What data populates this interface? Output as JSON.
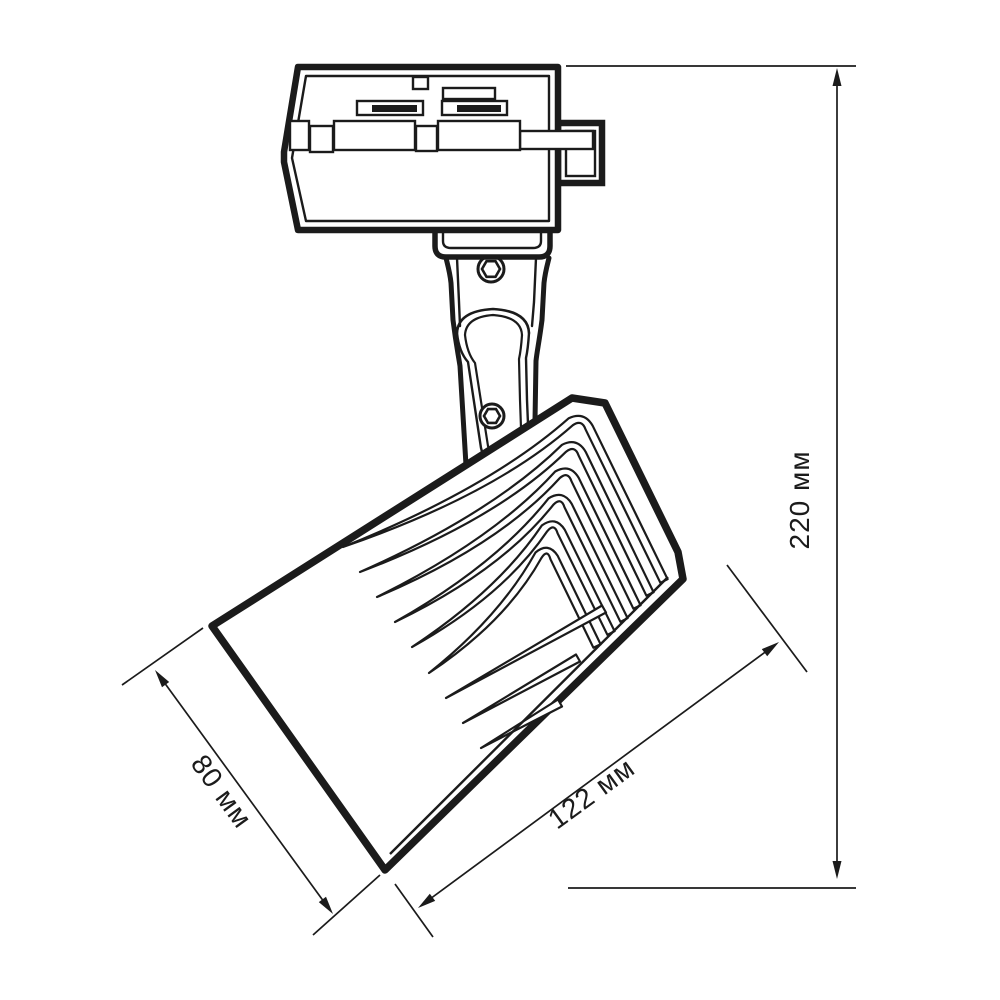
{
  "drawing": {
    "title": "track-spotlight-dimension-drawing",
    "dimensions": {
      "height_label": "220 мм",
      "length_label": "122 мм",
      "diameter_label": "80 мм"
    },
    "colors": {
      "line": "#1b1b1b",
      "background": "#ffffff"
    }
  }
}
